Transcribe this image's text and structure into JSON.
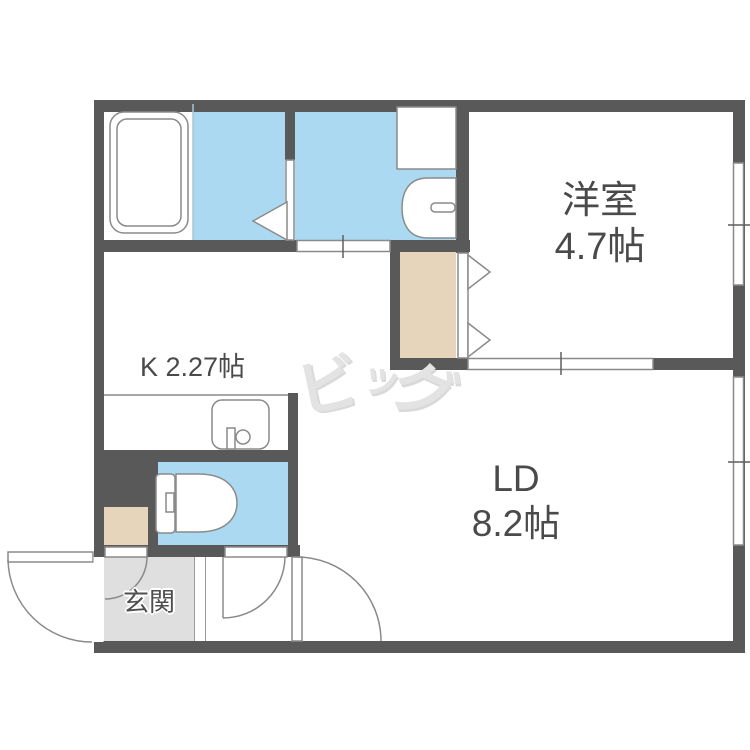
{
  "title": "apartment-floor-plan",
  "rooms": {
    "western_room": {
      "name": "洋室",
      "size": "4.7帖"
    },
    "kitchen": {
      "label": "K 2.27帖"
    },
    "living_dining": {
      "name": "LD",
      "size": "8.2帖"
    },
    "entrance": {
      "label": "玄関"
    },
    "bathroom": {
      "label": ""
    },
    "washroom": {
      "label": ""
    },
    "toilet": {
      "label": ""
    }
  },
  "watermark": {
    "text": "ビッグ",
    "char1": "ビ",
    "char2": "ッ",
    "char3": "グ"
  },
  "fixtures": {
    "bathtub": "svg-shape",
    "washing_machine_pan": "svg-shape",
    "washbasin": "svg-shape",
    "kitchen_sink": "svg-shape",
    "toilet_bowl": "svg-shape"
  },
  "colors": {
    "wall": "#595959",
    "water_area_floor": "#abd9f1",
    "closet_floor": "#e7d5bb",
    "entrance_floor": "#dfdfdf",
    "label_text": "#4a4a4a",
    "watermark": "#e3e3e3",
    "fixture_outline": "#8a8a8a"
  }
}
